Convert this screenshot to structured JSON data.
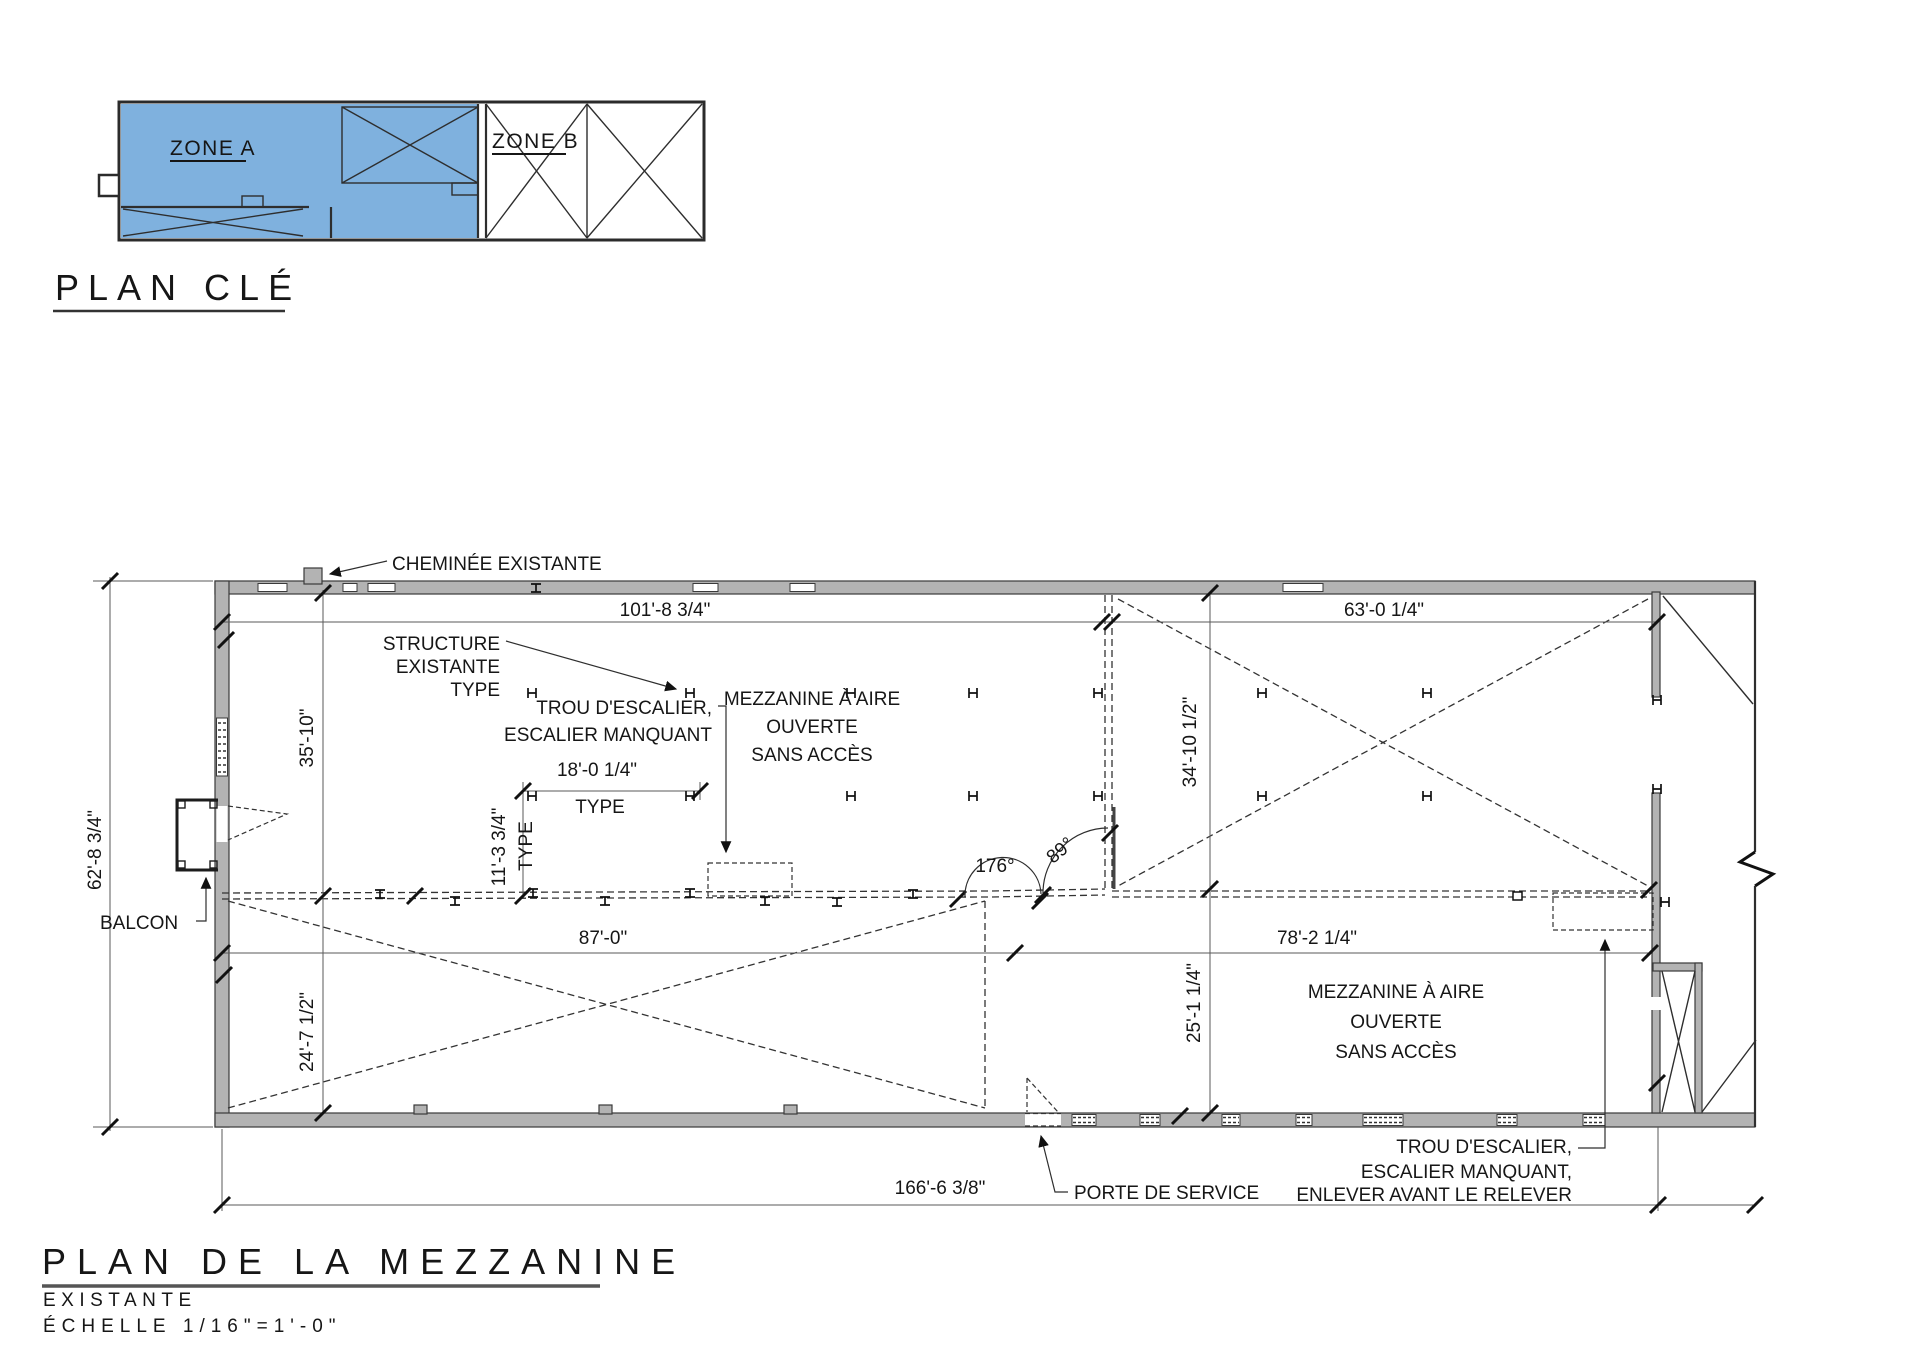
{
  "key_plan": {
    "title": "PLAN CLÉ",
    "zone_a": "ZONE A",
    "zone_b": "ZONE B"
  },
  "title_block": {
    "title": "PLAN DE LA MEZZANINE",
    "subtitle": "EXISTANTE",
    "scale": "ÉCHELLE 1/16\"=1'-0\""
  },
  "labels": {
    "chimney": "CHEMINÉE EXISTANTE",
    "structure_l1": "STRUCTURE",
    "structure_l2": "EXISTANTE",
    "structure_l3": "TYPE",
    "stair_upper_l1": "TROU D'ESCALIER,",
    "stair_upper_l2": "ESCALIER MANQUANT",
    "mezz_upper_l1": "MEZZANINE À AIRE",
    "mezz_upper_l2": "OUVERTE",
    "mezz_upper_l3": "SANS ACCÈS",
    "balcon": "BALCON",
    "porte": "PORTE DE SERVICE",
    "mezz_lower_l1": "MEZZANINE À AIRE",
    "mezz_lower_l2": "OUVERTE",
    "mezz_lower_l3": "SANS ACCÈS",
    "stair_lower_l1": "TROU D'ESCALIER,",
    "stair_lower_l2": "ESCALIER MANQUANT,",
    "stair_lower_l3": "ENLEVER AVANT LE RELEVER"
  },
  "dims": {
    "d101": "101'-8 3/4\"",
    "d63": "63'-0 1/4\"",
    "d35": "35'-10\"",
    "d62": "62'-8 3/4\"",
    "d34": "34'-10 1/2\"",
    "d18": "18'-0 1/4\"",
    "type18": "TYPE",
    "d11": "11'-3 3/4\"",
    "type11": "TYPE",
    "d87": "87'-0\"",
    "d78": "78'-2 1/4\"",
    "d24": "24'-7 1/2\"",
    "d25": "25'-1 1/4\"",
    "d166": "166'-6 3/8\"",
    "a176": "176°",
    "a89": "89°"
  },
  "colors": {
    "zone_blue": "#7FB1DE",
    "wall_gray": "#B3B3B3",
    "line_dark": "#1A1A1A"
  }
}
